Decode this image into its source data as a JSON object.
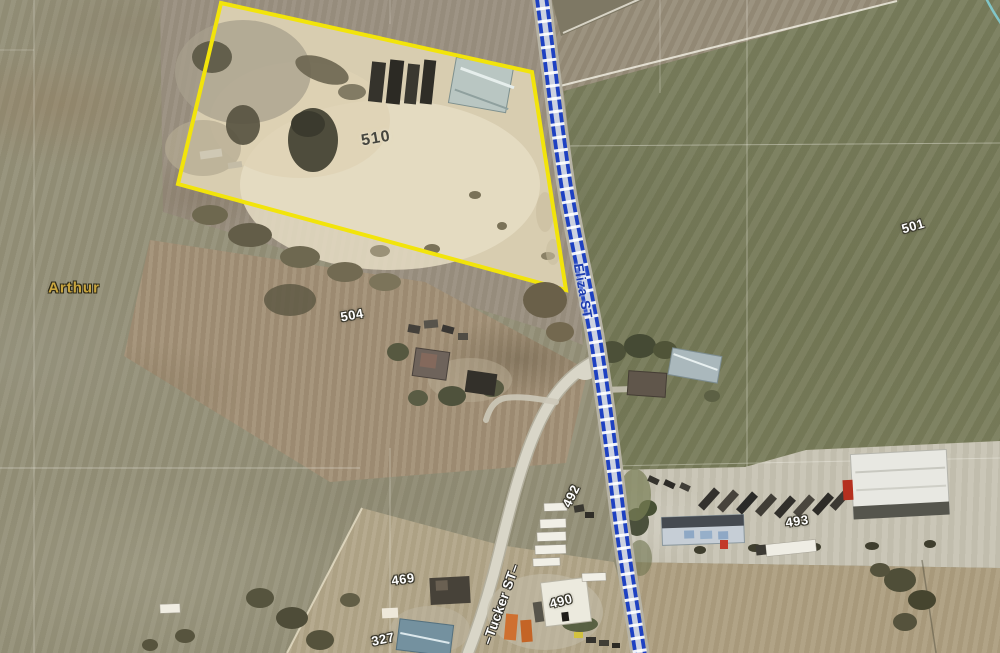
{
  "map": {
    "type": "gis-aerial-parcel-view",
    "labels": {
      "town": "Arthur",
      "street_eliza": "Eliza ST",
      "street_tucker": "–Tucker ST–",
      "parcel_510": "510",
      "parcel_504": "504",
      "parcel_501": "501",
      "parcel_493": "493",
      "parcel_492": "492",
      "parcel_490": "490",
      "parcel_469": "469",
      "parcel_327": "327"
    },
    "colors": {
      "parcel_highlight_yellow": "#F2E40B",
      "route_line_blue": "#1E41C2",
      "street_label_blue": "#1D3CAE",
      "town_label_gold": "#C9A53E",
      "parcel_label_white": "#FFFFFF",
      "stream_cyan": "#82D2DA"
    }
  }
}
